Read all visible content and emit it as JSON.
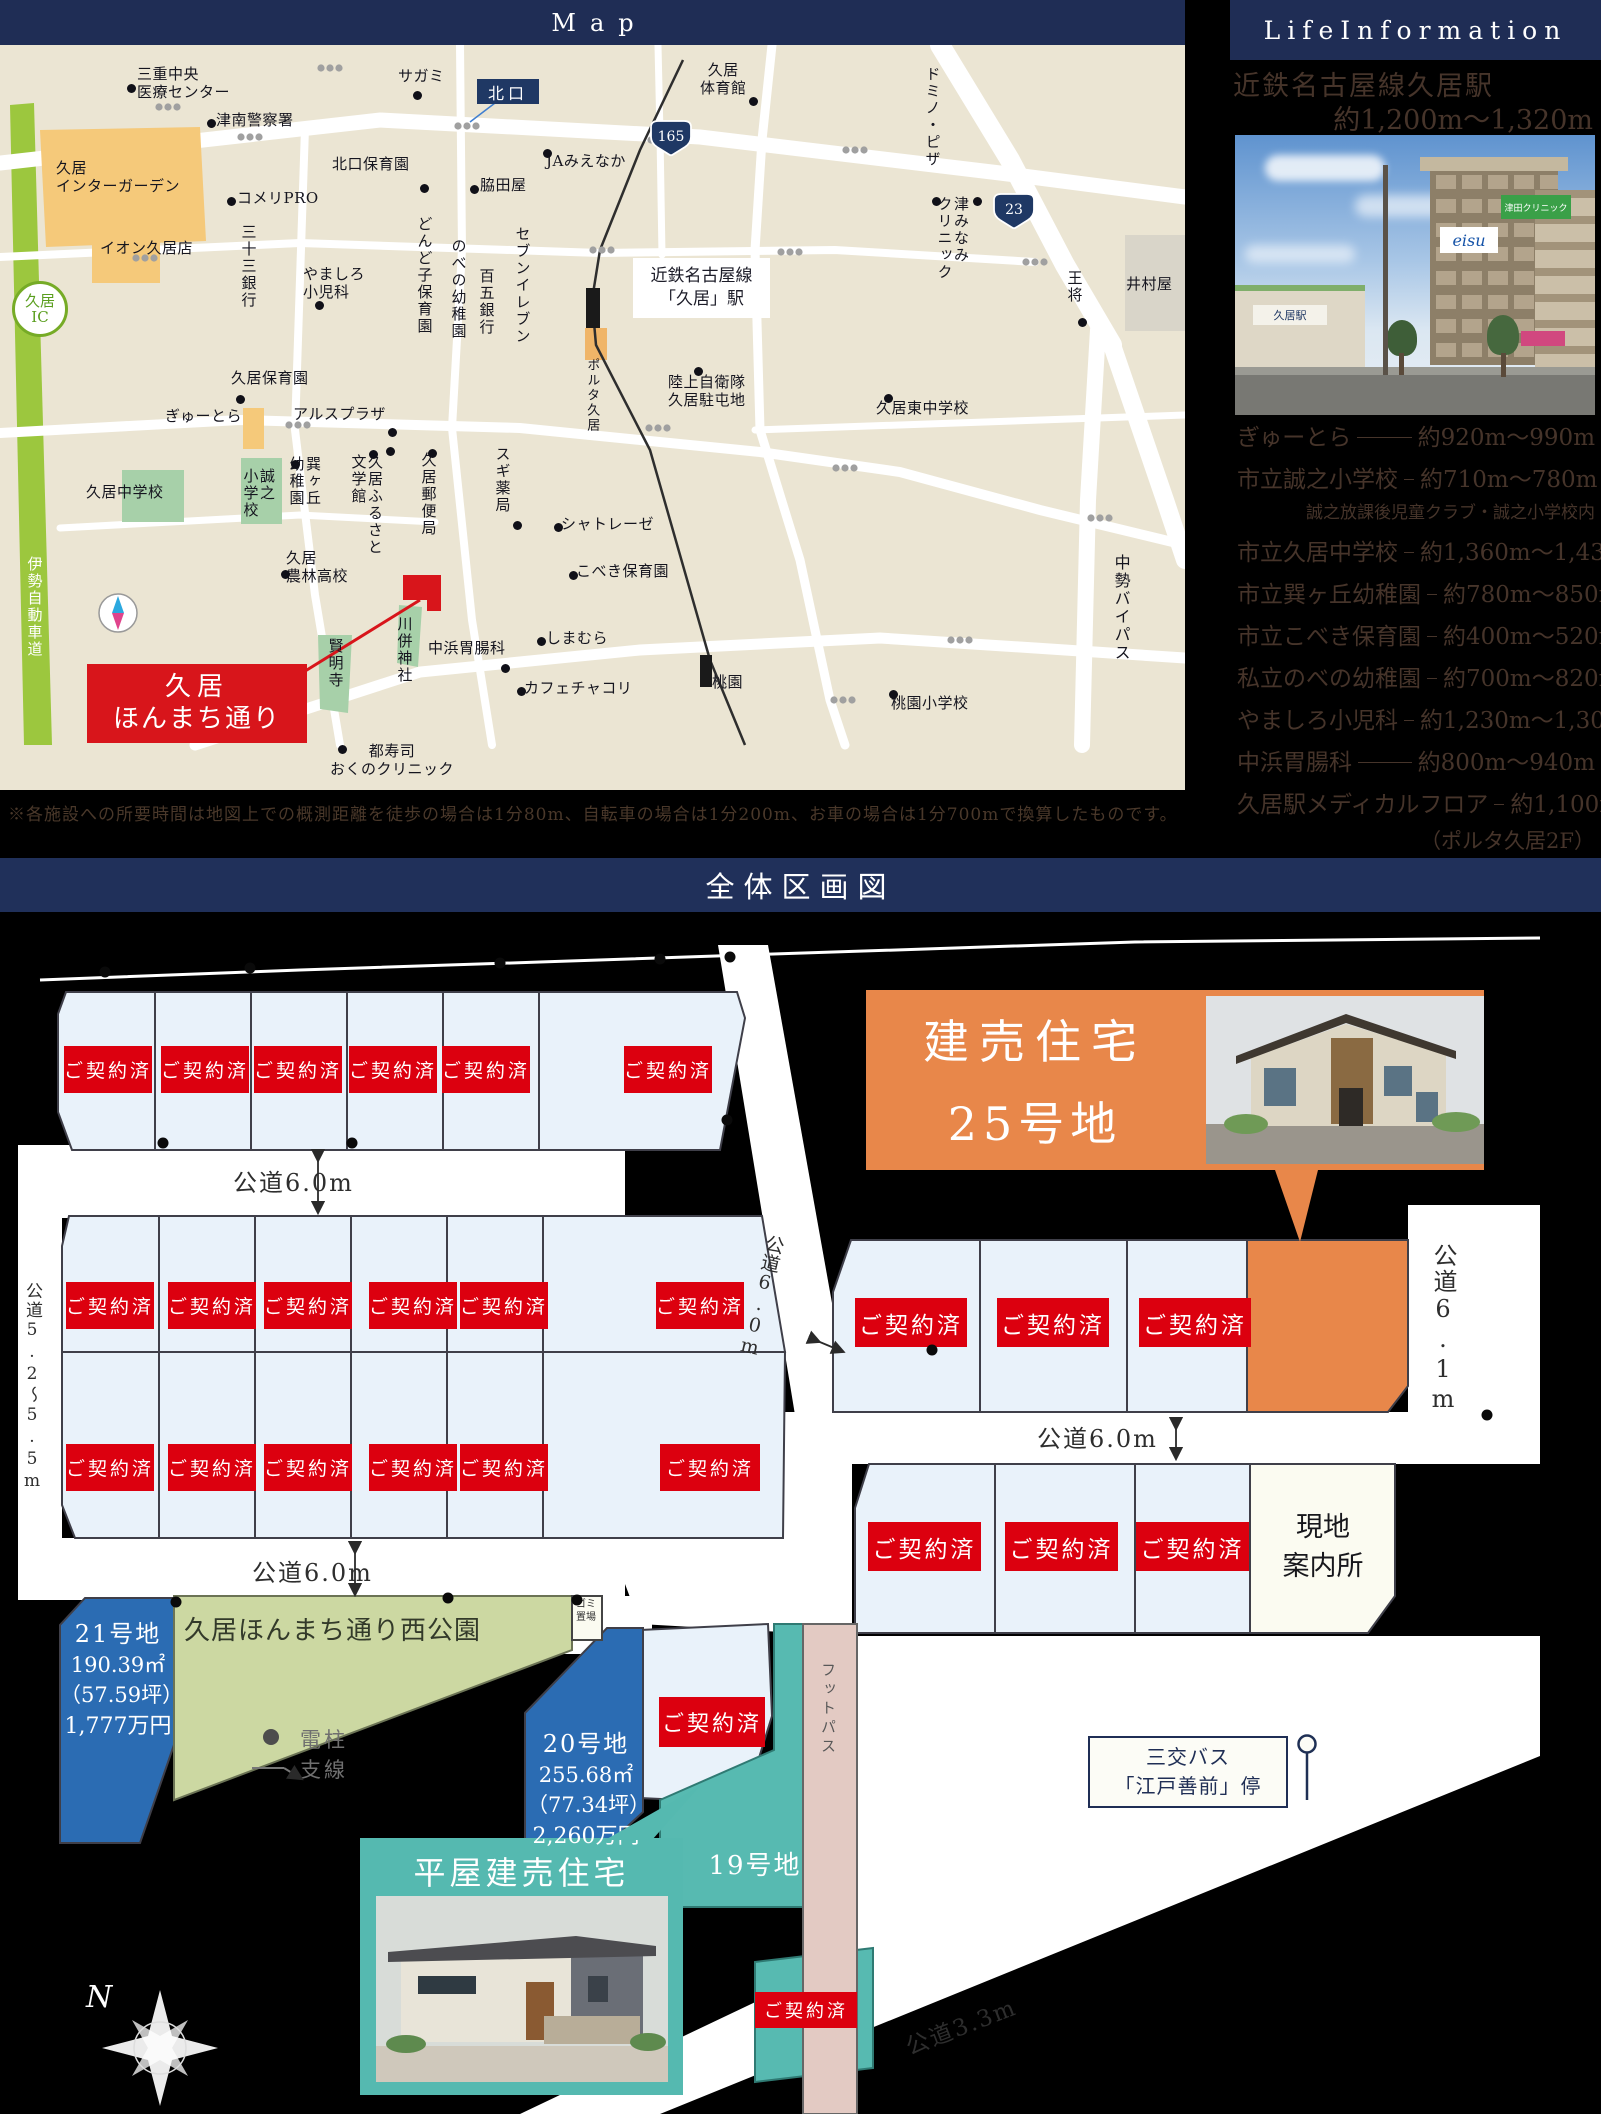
{
  "map": {
    "title": "Map",
    "north_gate": "北口",
    "station_line1": "近鉄名古屋線",
    "station_line2": "「久居」駅",
    "ic": "久居\nIC",
    "route165": "165",
    "route23": "23",
    "marker": {
      "line1": "久居",
      "line2": "ほんまち通り"
    },
    "labels": [
      "三重中央\n医療センター",
      "津南警察署",
      "久居\nインターガーデン",
      "イオン久居店",
      "コメリPRO",
      "北口保育園",
      "サガミ",
      "JAみえなか",
      "脇田屋",
      "久居\n体育館",
      "ドミノ・ピザ",
      "津みなみ\nクリニック",
      "王将",
      "井村屋",
      "陸上自衛隊\n久居駐屯地",
      "久居東中学校",
      "三十三銀行",
      "やましろ\n小児科",
      "どんど子保育園",
      "のべの幼稚園",
      "百五銀行",
      "セブンイレブン",
      "久居保育園",
      "ぎゅーとら",
      "アルスプラザ",
      "久居中学校",
      "誠之\n小学校",
      "巽ヶ丘\n幼稚園",
      "久居ふるさと\n文学館",
      "久居郵便局",
      "スギ薬局",
      "久居\n農林高校",
      "賢明寺",
      "川併神社",
      "中浜胃腸科",
      "しまむら",
      "カフェチャコリ",
      "シャトレーゼ",
      "こべき保育園",
      "都寿司\nおくのクリニック",
      "桃園小学校",
      "桃園",
      "中勢バイパス",
      "伊勢自動車道",
      "ポルタ久居"
    ]
  },
  "life_information": {
    "title": "LifeInformation",
    "station_name": "近鉄名古屋線久居駅",
    "station_distance": "約1,200m〜1,320m",
    "photo": {
      "sign1": "eisu",
      "sign2": "津田クリニック",
      "sign3": "久居駅"
    },
    "items": [
      {
        "name": "ぎゅーとら",
        "distance": "約920m〜990m"
      },
      {
        "name": "市立誠之小学校",
        "distance": "約710m〜780m",
        "note": "誠之放課後児童クラブ・誠之小学校内"
      },
      {
        "name": "市立久居中学校",
        "distance": "約1,360m〜1,430m"
      },
      {
        "name": "市立巽ヶ丘幼稚園",
        "distance": "約780m〜850m"
      },
      {
        "name": "市立こべき保育園",
        "distance": "約400m〜520m"
      },
      {
        "name": "私立のべの幼稚園",
        "distance": "約700m〜820m"
      },
      {
        "name": "やましろ小児科",
        "distance": "約1,230m〜1,300m"
      },
      {
        "name": "中浜胃腸科",
        "distance": "約800m〜940m"
      },
      {
        "name": "久居駅メディカルフロア",
        "distance": "約1,100m〜1,230m",
        "note": "（ポルタ久居2F）"
      }
    ]
  },
  "disclaimer": "※各施設への所要時間は地図上での概測距離を徒歩の場合は1分80m、自転車の場合は1分200m、お車の場合は1分700mで換算したものです。",
  "site_plan": {
    "title": "全体区画図",
    "sold_label": "ご契約済",
    "road_6": "公道6.0m",
    "road_52": "公道5.2〜5.5m",
    "road_61": "公道6.1m",
    "road_33": "公道3.3m",
    "banner25_line1": "建売住宅",
    "banner25_line2": "25号地",
    "hiraya": "平屋建売住宅",
    "lot21": {
      "name": "21号地",
      "area": "190.39㎡",
      "tsubo": "（57.59坪）",
      "price": "1,777万円"
    },
    "lot20": {
      "name": "20号地",
      "area": "255.68㎡",
      "tsubo": "（77.34坪）",
      "price": "2,260万円"
    },
    "lot19": "19号地",
    "park": "久居ほんまち通り西公園",
    "trash": "ゴミ置場",
    "office": "現地\n案内所",
    "footpath": "フットパス",
    "bus_line1": "三交バス",
    "bus_line2": "「江戸善前」停",
    "legend_pole": "電柱",
    "legend_wire": "支線",
    "north": "N"
  }
}
